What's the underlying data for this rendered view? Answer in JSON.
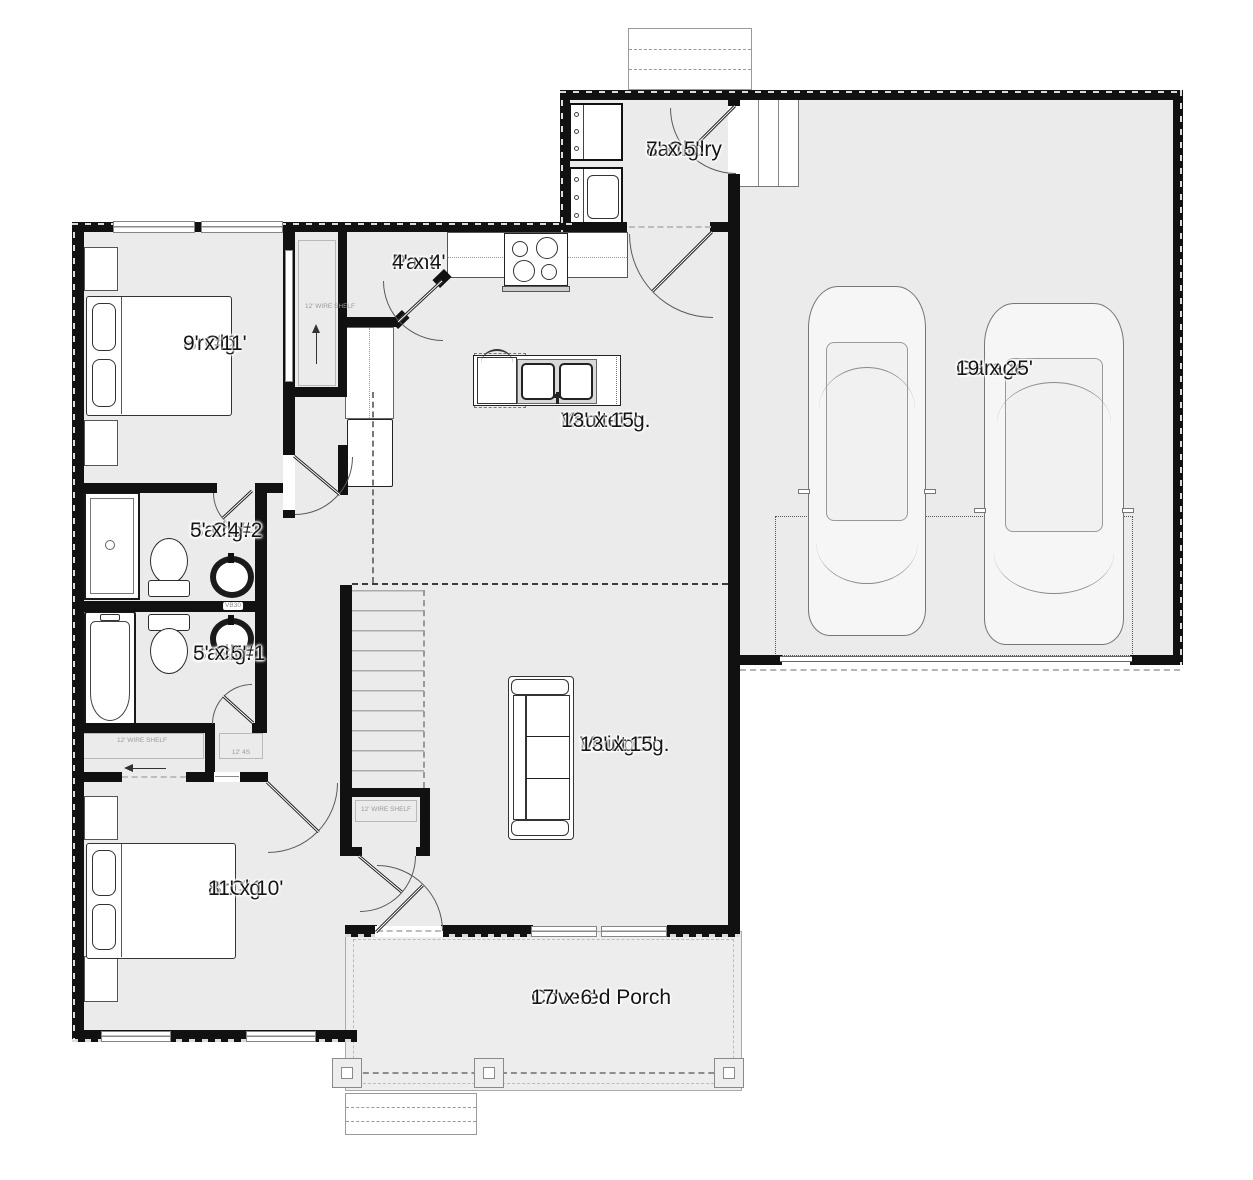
{
  "rooms": {
    "laundry": {
      "name": "Laundry",
      "ceiling": "8' Clg.",
      "size": "7' x 5'"
    },
    "pantry": {
      "name": "Pant.",
      "size": "4' x 4'"
    },
    "br2": {
      "name": "Br. #2",
      "ceiling": "8' Clg.",
      "size": "9' x 11'"
    },
    "kitchen": {
      "name": "Kitchen",
      "ceiling": "Vault Clg.",
      "size": "13' x 15'"
    },
    "bath2": {
      "name": "Bath #2",
      "ceiling": "8' Clg.",
      "size": "5' x 4'"
    },
    "bath1": {
      "name": "Bath #1",
      "ceiling": "8' Clg.",
      "size": "5' x 5'"
    },
    "garage": {
      "name": "Garage",
      "size": "19' x 25'"
    },
    "living": {
      "name": "Living",
      "ceiling": "Vault Clg.",
      "size": "13' x 15'"
    },
    "br1": {
      "name": "Br. #1",
      "ceiling": "8' Clg.",
      "size": "11' x 10'"
    },
    "porch": {
      "name": "Covered Porch",
      "size": "17' x 6'"
    }
  },
  "labels": {
    "br2_closet_shelf": "12' WIRE SHELF",
    "br1_closet_shelf": "12' WIRE SHELF",
    "hall_closet_shelf": "12' WIRE SHELF",
    "small_closet": "12' 4S",
    "vanity_bath2": "VB30",
    "door_size": "30"
  },
  "colors": {
    "wall": "#111111",
    "floor": "#ebebeb",
    "porch_floor": "#ededed",
    "fixture_line": "#555555",
    "muted_text": "#9a9a9a"
  }
}
